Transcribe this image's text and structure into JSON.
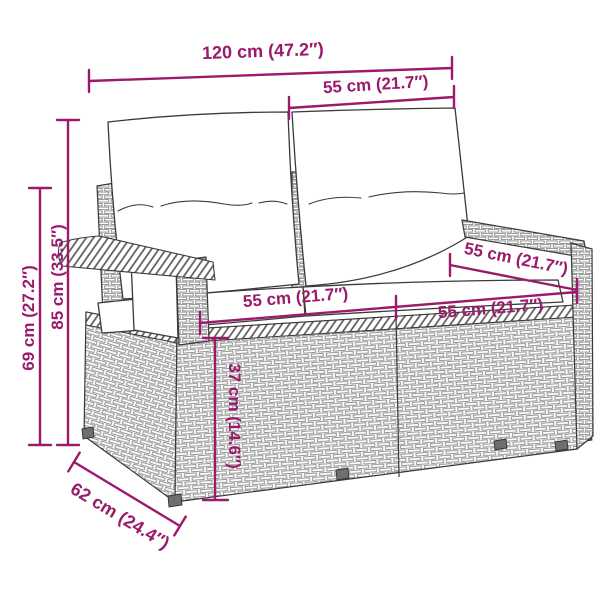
{
  "diagram": {
    "type": "product-dimension-diagram",
    "subject": "poly rattan 2-seater garden sofa with back and seat cushions",
    "accent_color": "#9B1A6B",
    "outline_color": "#3a3a3a",
    "background_color": "#ffffff"
  },
  "dimensions": {
    "overall_width": {
      "label": "120 cm (47.2″)"
    },
    "back_section_width": {
      "label": "55 cm (21.7″)"
    },
    "overall_height": {
      "label": "85 cm (33.5″)"
    },
    "armrest_height": {
      "label": "69 cm (27.2″)"
    },
    "seat_width_left": {
      "label": "55 cm (21.7″)"
    },
    "seat_width_right": {
      "label": "55 cm (21.7″)"
    },
    "seat_depth": {
      "label": "55 cm (21.7″)"
    },
    "seat_height": {
      "label": "37 cm (14.6″)"
    },
    "overall_depth": {
      "label": "62 cm (24.4″)"
    }
  }
}
